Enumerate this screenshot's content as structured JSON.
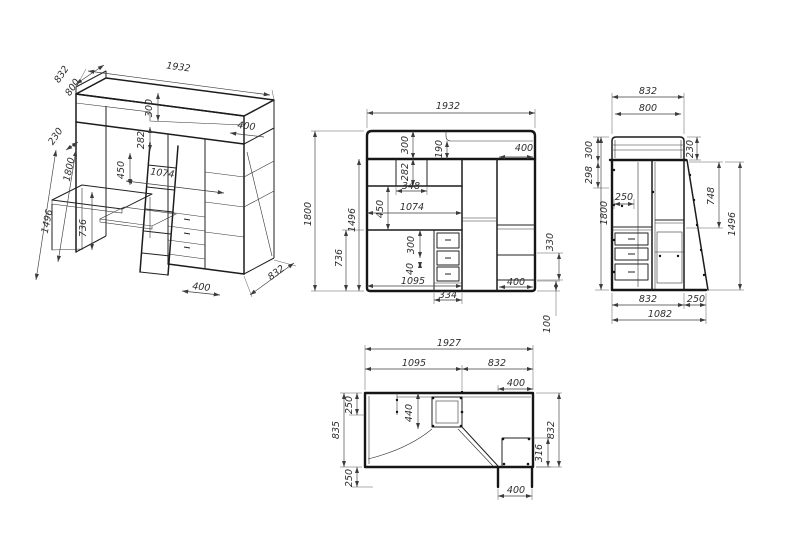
{
  "colors": {
    "background": "#ffffff",
    "object_line": "#161616",
    "dimension_line": "#3c3c3c",
    "text": "#2d2d2d"
  },
  "views": {
    "iso": {
      "title": "isometric-projection",
      "dims": {
        "d832_top": "832",
        "d800": "800",
        "d1932": "1932",
        "d230": "230",
        "d1800": "1800",
        "d1496": "1496",
        "d300": "300",
        "d282": "282",
        "d450": "450",
        "d1074": "1074",
        "d400_top": "400",
        "d736": "736",
        "d400_bottom": "400",
        "d832_bottom": "832"
      }
    },
    "front": {
      "title": "front-elevation",
      "dims": {
        "d1932": "1932",
        "d1800": "1800",
        "d736": "736",
        "d1496": "1496",
        "d300_top": "300",
        "d282": "282",
        "d190": "190",
        "d348": "348",
        "d450": "450",
        "d1074": "1074",
        "d400_top": "400",
        "d300_drawer": "300",
        "d40": "40",
        "d1095": "1095",
        "d334": "334",
        "d330": "330",
        "d400_bottom": "400",
        "d100": "100"
      }
    },
    "side": {
      "title": "side-elevation",
      "dims": {
        "d832_top": "832",
        "d800": "800",
        "d230": "230",
        "d300": "300",
        "d298": "298",
        "d250": "250",
        "d1800": "1800",
        "d748": "748",
        "d1496": "1496",
        "d832_bottom": "832",
        "d250_bottom": "250",
        "d1082": "1082"
      }
    },
    "plan": {
      "title": "plan-view",
      "dims": {
        "d1927": "1927",
        "d1095": "1095",
        "d832_top": "832",
        "d400_top": "400",
        "d250_top_left": "250",
        "d835": "835",
        "d250_bottom_left": "250",
        "d440": "440",
        "d316": "316",
        "d832_right": "832",
        "d400_bottom": "400"
      }
    }
  }
}
